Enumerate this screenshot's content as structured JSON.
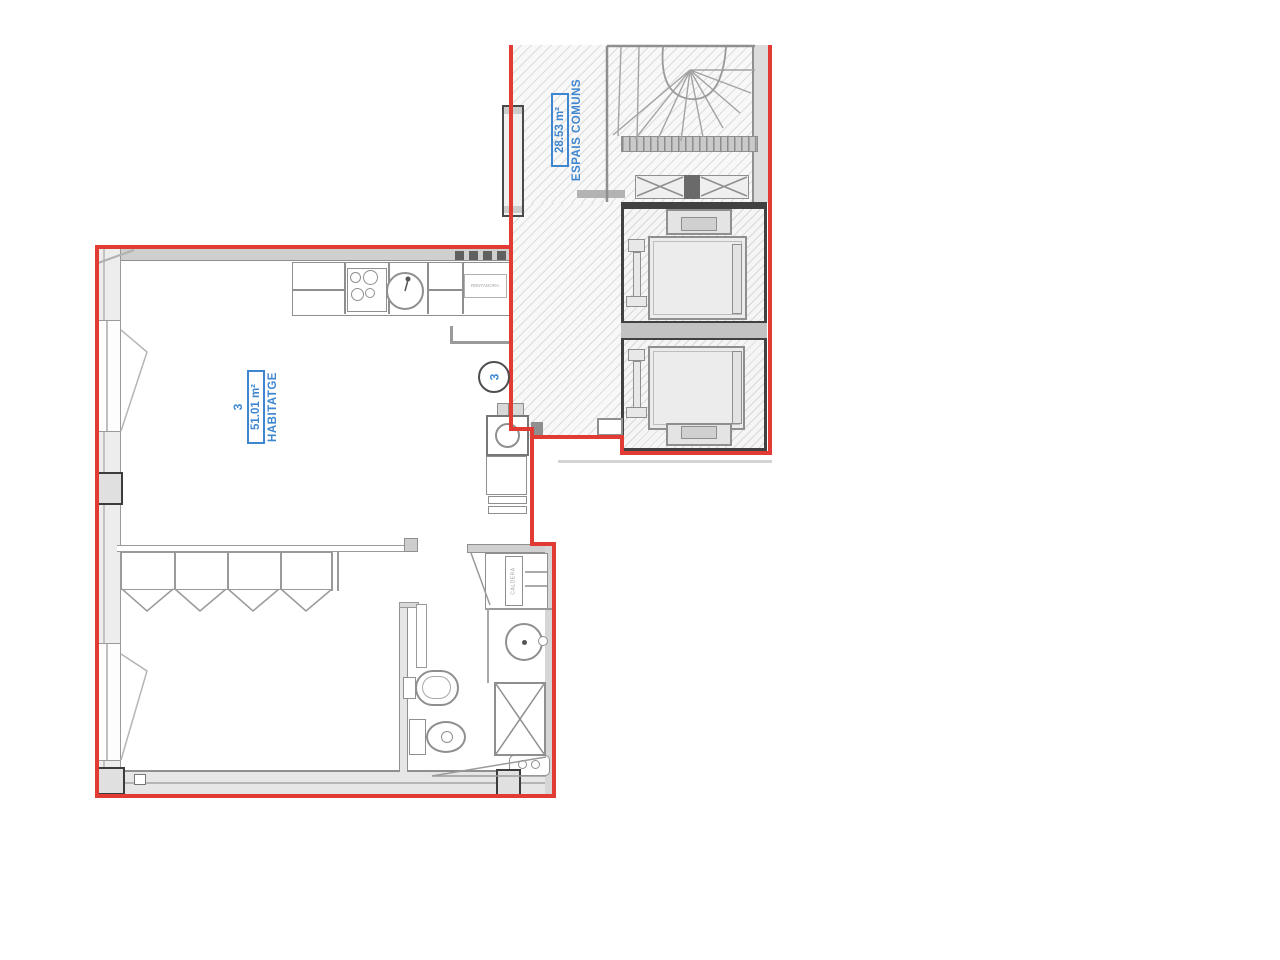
{
  "plan": {
    "apartment": {
      "unit_number": "3",
      "area_label": "51.01 m²",
      "room_name": "HABITATGE",
      "door_badge": "3"
    },
    "common_area": {
      "area_label": "28.53 m²",
      "name": "ESPAIS COMUNS"
    },
    "equipment": {
      "washer_label": "RENTADORA",
      "boiler_label": "CALDERA"
    },
    "colors": {
      "property_line_red": "#e23b33",
      "label_blue": "#3e87d0",
      "wall_gray": "#8f8f8f",
      "dark_wall": "#414141"
    }
  }
}
